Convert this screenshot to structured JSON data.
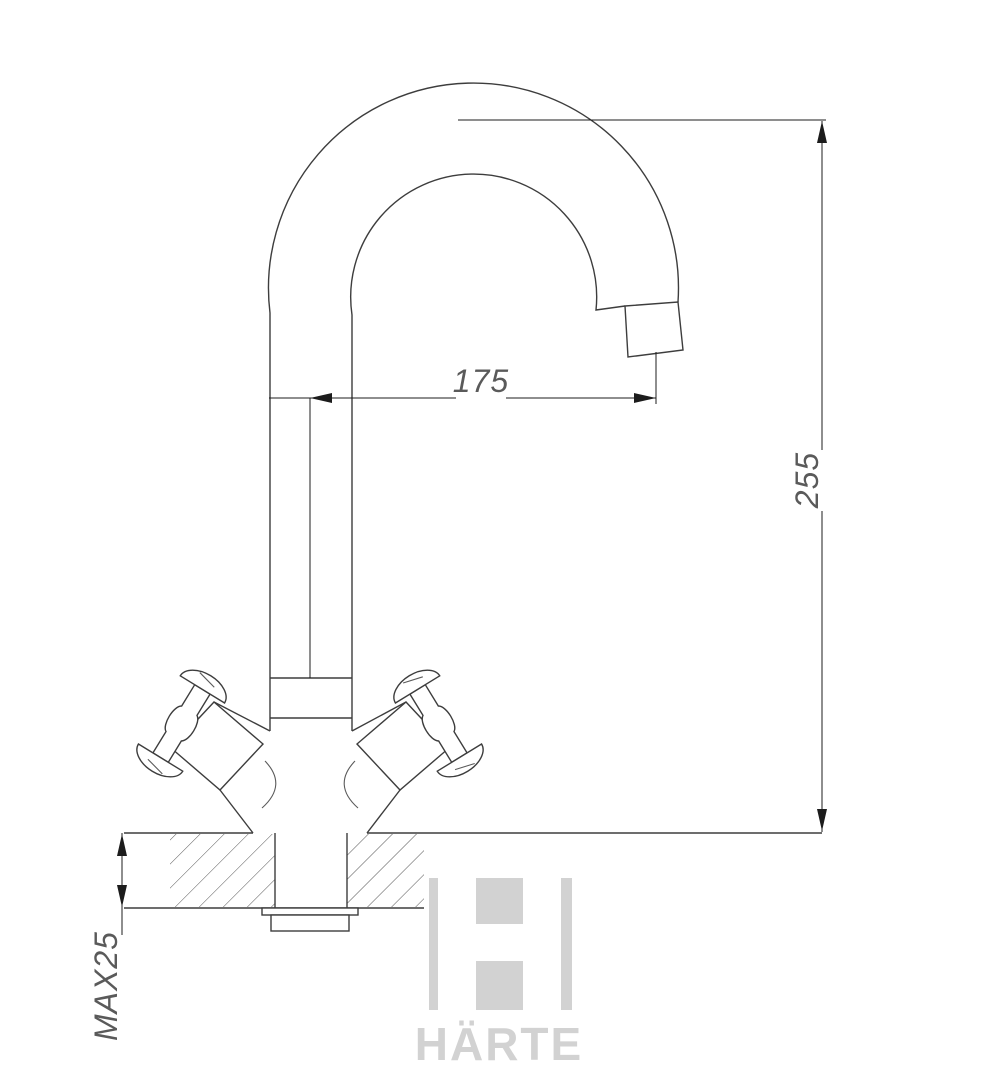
{
  "drawing": {
    "type": "faucet installation dimension drawing",
    "dimensions": {
      "spout_reach": "175",
      "overall_height": "255",
      "max_deck_thickness": "MAX25"
    }
  },
  "watermark": {
    "brand": "HÄRTE"
  },
  "colors": {
    "line": "#3d3d3d",
    "thin": "#5a5a5a",
    "dim": "#1c1c1c",
    "dimtext": "#5a5a5a",
    "watermark": "#d2d2d2",
    "background": "#ffffff"
  }
}
